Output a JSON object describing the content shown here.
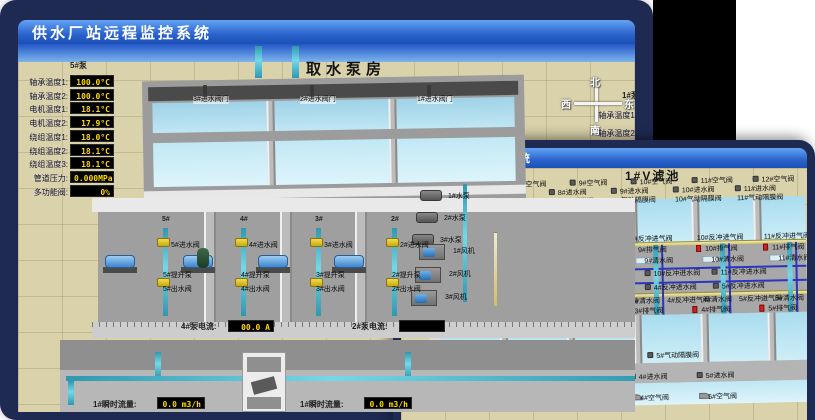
{
  "colors": {
    "frame_navy": "#1e2a52",
    "titlebar_top": "#63a3f5",
    "titlebar_bottom": "#1b50b4",
    "ground_tan": "#d9d2ab",
    "water_blue": "#b9e2f1",
    "display_text": "#ffd900",
    "alarm_red": "#d42020",
    "pipe_cyan": "#3fb6cf",
    "pipe_yellow": "#e3d88e",
    "pipe_blue": "#2a35c0"
  },
  "back_window": {
    "title": "供水厂站远程监控系统",
    "scene_title": "取水泵房",
    "compass": {
      "north": "北",
      "west": "西",
      "south": "南",
      "east": "东"
    },
    "pump_panel": {
      "header": "5#泵",
      "rows": [
        {
          "label": "轴承温度1:",
          "value": "100.0°C"
        },
        {
          "label": "轴承温度2:",
          "value": "100.0°C"
        },
        {
          "label": "电机温度1:",
          "value": "18.1°C"
        },
        {
          "label": "电机温度2:",
          "value": "17.9°C"
        },
        {
          "label": "绕组温度1:",
          "value": "18.0°C"
        },
        {
          "label": "绕组温度2:",
          "value": "18.1°C"
        },
        {
          "label": "绕组温度3:",
          "value": "18.1°C"
        },
        {
          "label": "管道压力:",
          "value": "0.000MPa"
        },
        {
          "label": "多功能阀:",
          "value": "0%"
        }
      ]
    },
    "basin_valves": [
      "3#进水阀门",
      "2#进水阀门",
      "1#进水阀门"
    ],
    "pump_sections": [
      {
        "id": "5#",
        "inlet": "5#进水阀",
        "pump": "5#提升泵",
        "outlet": "5#出水阀"
      },
      {
        "id": "4#",
        "inlet": "4#进水阀",
        "pump": "4#提升泵",
        "outlet": "4#出水阀"
      },
      {
        "id": "3#",
        "inlet": "3#进水阀",
        "pump": "3#提升泵",
        "outlet": "3#出水阀"
      },
      {
        "id": "2#",
        "inlet": "2#进水阀",
        "pump": "2#提升泵",
        "outlet": "2#出水阀"
      }
    ],
    "current_displays": [
      {
        "label": "4#泵电流:",
        "value": "00.0 A"
      },
      {
        "label": "2#泵电流:",
        "value": ""
      }
    ],
    "flow_displays": [
      {
        "label": "1#瞬时流量:",
        "value": "0.0 m3/h"
      },
      {
        "label": "1#瞬时流量:",
        "value": "0.0 m3/h"
      }
    ],
    "right_partial": {
      "header": "1#泵",
      "rows": [
        "轴承温度1:",
        "轴承温度2:"
      ]
    }
  },
  "front_window": {
    "title": "供水厂站远程监控系统",
    "scene_title": "1#V滤池",
    "top_air_valves": [
      "7#空气阀",
      "8#空气阀",
      "9#空气阀",
      "10#空气阀",
      "11#空气阀",
      "12#空气阀"
    ],
    "top_inlet_valves": [
      "7#进水阀",
      "8#进水阀",
      "9#进水阀",
      "10#进水阀",
      "11#进水阀"
    ],
    "top_diaphragm_valves": [
      "7#气动隔膜阀",
      "8#气动隔膜阀",
      "9#气动隔膜阀",
      "10#气动隔膜阀",
      "11#气动隔膜阀"
    ],
    "upper_backwash_air": [
      "7#反冲进气阀",
      "8#反冲进气阀",
      "9#反冲进气阀",
      "10#反冲进气阀",
      "11#反冲进气阀"
    ],
    "upper_exhaust": [
      "7#排气阀",
      "8#排气阀",
      "9#排气阀",
      "10#排气阀",
      "11#排气阀"
    ],
    "upper_clean": [
      "7#清水阀",
      "8#清水阀",
      "9#清水阀",
      "10#清水阀",
      "11#清水阀"
    ],
    "upper_backwash_water": [
      "7#反冲进水阀",
      "8#反冲进水阀",
      "9#反冲进水阀",
      "10#反冲进水阀",
      "11#反冲进水阀"
    ],
    "lower_backwash_water": [
      "2#反冲进水阀",
      "3#反冲进水阀",
      "4#反冲进水阀",
      "5#反冲进水阀"
    ],
    "lower_mixed": [
      "1#清水阀",
      "2#反冲进气阀",
      "2#清水阀",
      "3#反冲进气阀",
      "3#清水阀",
      "4#反冲进气阀",
      "4#清水阀",
      "5#反冲进气阀",
      "5#清水阀"
    ],
    "lower_exhaust": [
      "1#排气阀",
      "2#排气阀",
      "3#排气阀",
      "4#排气阀",
      "5#排气阀"
    ],
    "left_valves": [
      "1#反冲进水阀",
      "1#反冲进气阀"
    ],
    "bottom_diaphragm": [
      "1#气动隔膜阀",
      "2#气动隔膜阀",
      "3#气动隔膜阀",
      "4#气动隔膜阀",
      "5#气动隔膜阀"
    ],
    "bottom_inlet": [
      "1#进水阀",
      "2#进水阀",
      "3#进水阀",
      "4#进水阀",
      "5#进水阀"
    ],
    "bottom_air": [
      "1#空气阀",
      "2#空气阀",
      "3#空气阀",
      "4#空气阀",
      "5#空气阀"
    ],
    "pumps": [
      "1#水泵",
      "2#水泵",
      "3#水泵"
    ],
    "blowers": [
      "1#风机",
      "2#风机",
      "3#风机"
    ]
  }
}
